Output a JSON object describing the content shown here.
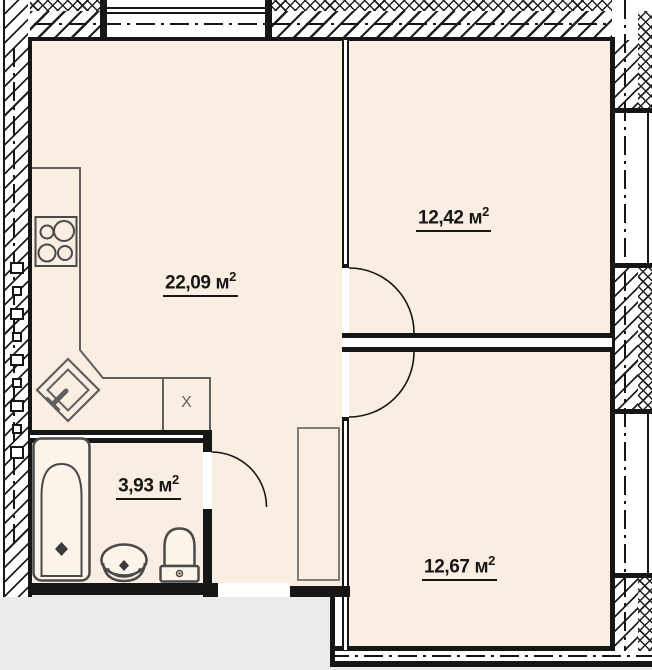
{
  "rooms": [
    {
      "id": "living-kitchen",
      "label": "22,09 м",
      "sup": "2"
    },
    {
      "id": "bedroom-upper",
      "label": "12,42 м",
      "sup": "2"
    },
    {
      "id": "bedroom-lower",
      "label": "12,67 м",
      "sup": "2"
    },
    {
      "id": "bathroom",
      "label": "3,93 м",
      "sup": "2"
    }
  ],
  "kitchen": {
    "x_unit_label": "X"
  },
  "colors": {
    "room_fill": "#faeee3",
    "outside_fill": "#ebebeb",
    "wall_ink": "#161616",
    "fixture_ink": "#4a4a4a",
    "counter_ink": "#5f5f5f",
    "wardrobe_ink": "#7c7c78"
  }
}
